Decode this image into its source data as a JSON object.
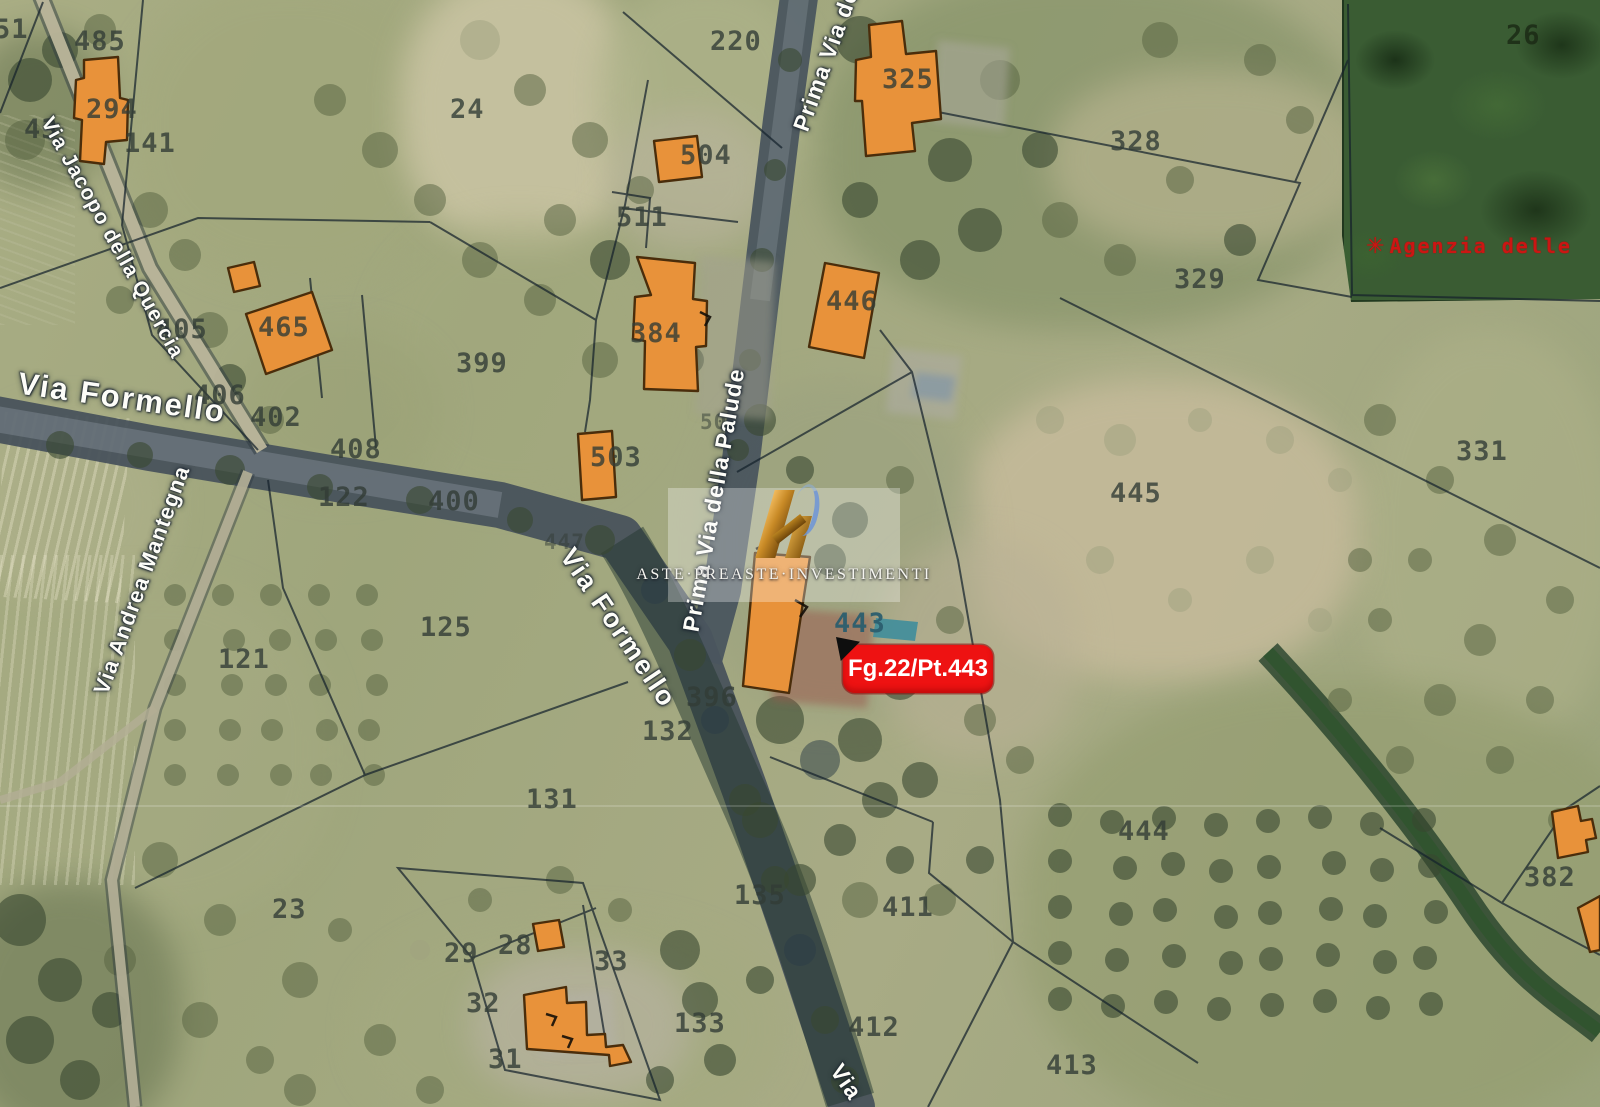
{
  "pin": {
    "label": "Fg.22/Pt.443",
    "color": "#ee1212"
  },
  "watermark": {
    "brand": "Aste·Preaste·Investimenti",
    "logo": "gold-api-monogram"
  },
  "attribution": {
    "label": "Agenzia delle",
    "logo": "agenzia-entrate-seal",
    "color": "#d31212"
  },
  "colors": {
    "building_fill": "#e8923a",
    "building_stroke": "#4a2d0b",
    "parcel_line": "#15222c",
    "road": "#46515a",
    "forest": "#3a5c33",
    "pool": "#3f8d9b"
  },
  "streets": [
    {
      "label": "Via Formello",
      "x": 122,
      "y": 398,
      "rot": 8,
      "size": 31,
      "ls": 2
    },
    {
      "label": "Via Formello",
      "x": 618,
      "y": 628,
      "rot": 56,
      "size": 27,
      "ls": 2
    },
    {
      "label": "Via Jacopo della Quercia",
      "x": 112,
      "y": 238,
      "rot": 61,
      "size": 21,
      "ls": 1
    },
    {
      "label": "Via Andrea Mantegna",
      "x": 142,
      "y": 580,
      "rot": -70,
      "size": 22,
      "ls": 1
    },
    {
      "label": "Prima Via della Palude",
      "x": 714,
      "y": 500,
      "rot": -80,
      "size": 23,
      "ls": 1
    },
    {
      "label": "Prima Via de",
      "x": 826,
      "y": 60,
      "rot": -70,
      "size": 23,
      "ls": 1
    },
    {
      "label": "Via",
      "x": 846,
      "y": 1082,
      "rot": 56,
      "size": 23,
      "ls": 1
    }
  ],
  "parcels": [
    {
      "n": "51",
      "x": -6,
      "y": 14
    },
    {
      "n": "485",
      "x": 74,
      "y": 26
    },
    {
      "n": "294",
      "x": 86,
      "y": 94
    },
    {
      "n": "43",
      "x": 24,
      "y": 114
    },
    {
      "n": "141",
      "x": 124,
      "y": 128
    },
    {
      "n": "220",
      "x": 710,
      "y": 26
    },
    {
      "n": "24",
      "x": 450,
      "y": 94
    },
    {
      "n": "504",
      "x": 680,
      "y": 140
    },
    {
      "n": "511",
      "x": 616,
      "y": 202
    },
    {
      "n": "325",
      "x": 882,
      "y": 64
    },
    {
      "n": "328",
      "x": 1110,
      "y": 126
    },
    {
      "n": "329",
      "x": 1174,
      "y": 264
    },
    {
      "n": "26",
      "x": 1506,
      "y": 20,
      "cls": "forestp"
    },
    {
      "n": "331",
      "x": 1456,
      "y": 436
    },
    {
      "n": "405",
      "x": 156,
      "y": 314
    },
    {
      "n": "465",
      "x": 258,
      "y": 312
    },
    {
      "n": "406",
      "x": 194,
      "y": 380
    },
    {
      "n": "402",
      "x": 250,
      "y": 402
    },
    {
      "n": "408",
      "x": 330,
      "y": 434
    },
    {
      "n": "122",
      "x": 318,
      "y": 482
    },
    {
      "n": "400",
      "x": 428,
      "y": 486
    },
    {
      "n": "503",
      "x": 590,
      "y": 442
    },
    {
      "n": "384",
      "x": 630,
      "y": 318
    },
    {
      "n": "50",
      "x": 700,
      "y": 410,
      "cls": "faint"
    },
    {
      "n": "399",
      "x": 456,
      "y": 348
    },
    {
      "n": "446",
      "x": 826,
      "y": 286
    },
    {
      "n": "445",
      "x": 1110,
      "y": 478
    },
    {
      "n": "447",
      "x": 544,
      "y": 530,
      "cls": "faint"
    },
    {
      "n": "121",
      "x": 218,
      "y": 644
    },
    {
      "n": "125",
      "x": 420,
      "y": 612
    },
    {
      "n": "443",
      "x": 834,
      "y": 608,
      "cls": "teal"
    },
    {
      "n": "396",
      "x": 686,
      "y": 682
    },
    {
      "n": "132",
      "x": 642,
      "y": 716
    },
    {
      "n": "131",
      "x": 526,
      "y": 784
    },
    {
      "n": "23",
      "x": 272,
      "y": 894
    },
    {
      "n": "29",
      "x": 444,
      "y": 938
    },
    {
      "n": "28",
      "x": 498,
      "y": 930
    },
    {
      "n": "33",
      "x": 594,
      "y": 946
    },
    {
      "n": "32",
      "x": 466,
      "y": 988
    },
    {
      "n": "31",
      "x": 488,
      "y": 1044
    },
    {
      "n": "133",
      "x": 674,
      "y": 1008
    },
    {
      "n": "135",
      "x": 734,
      "y": 880
    },
    {
      "n": "411",
      "x": 882,
      "y": 892
    },
    {
      "n": "412",
      "x": 848,
      "y": 1012
    },
    {
      "n": "413",
      "x": 1046,
      "y": 1050
    },
    {
      "n": "444",
      "x": 1118,
      "y": 816
    },
    {
      "n": "382",
      "x": 1524,
      "y": 862
    }
  ]
}
